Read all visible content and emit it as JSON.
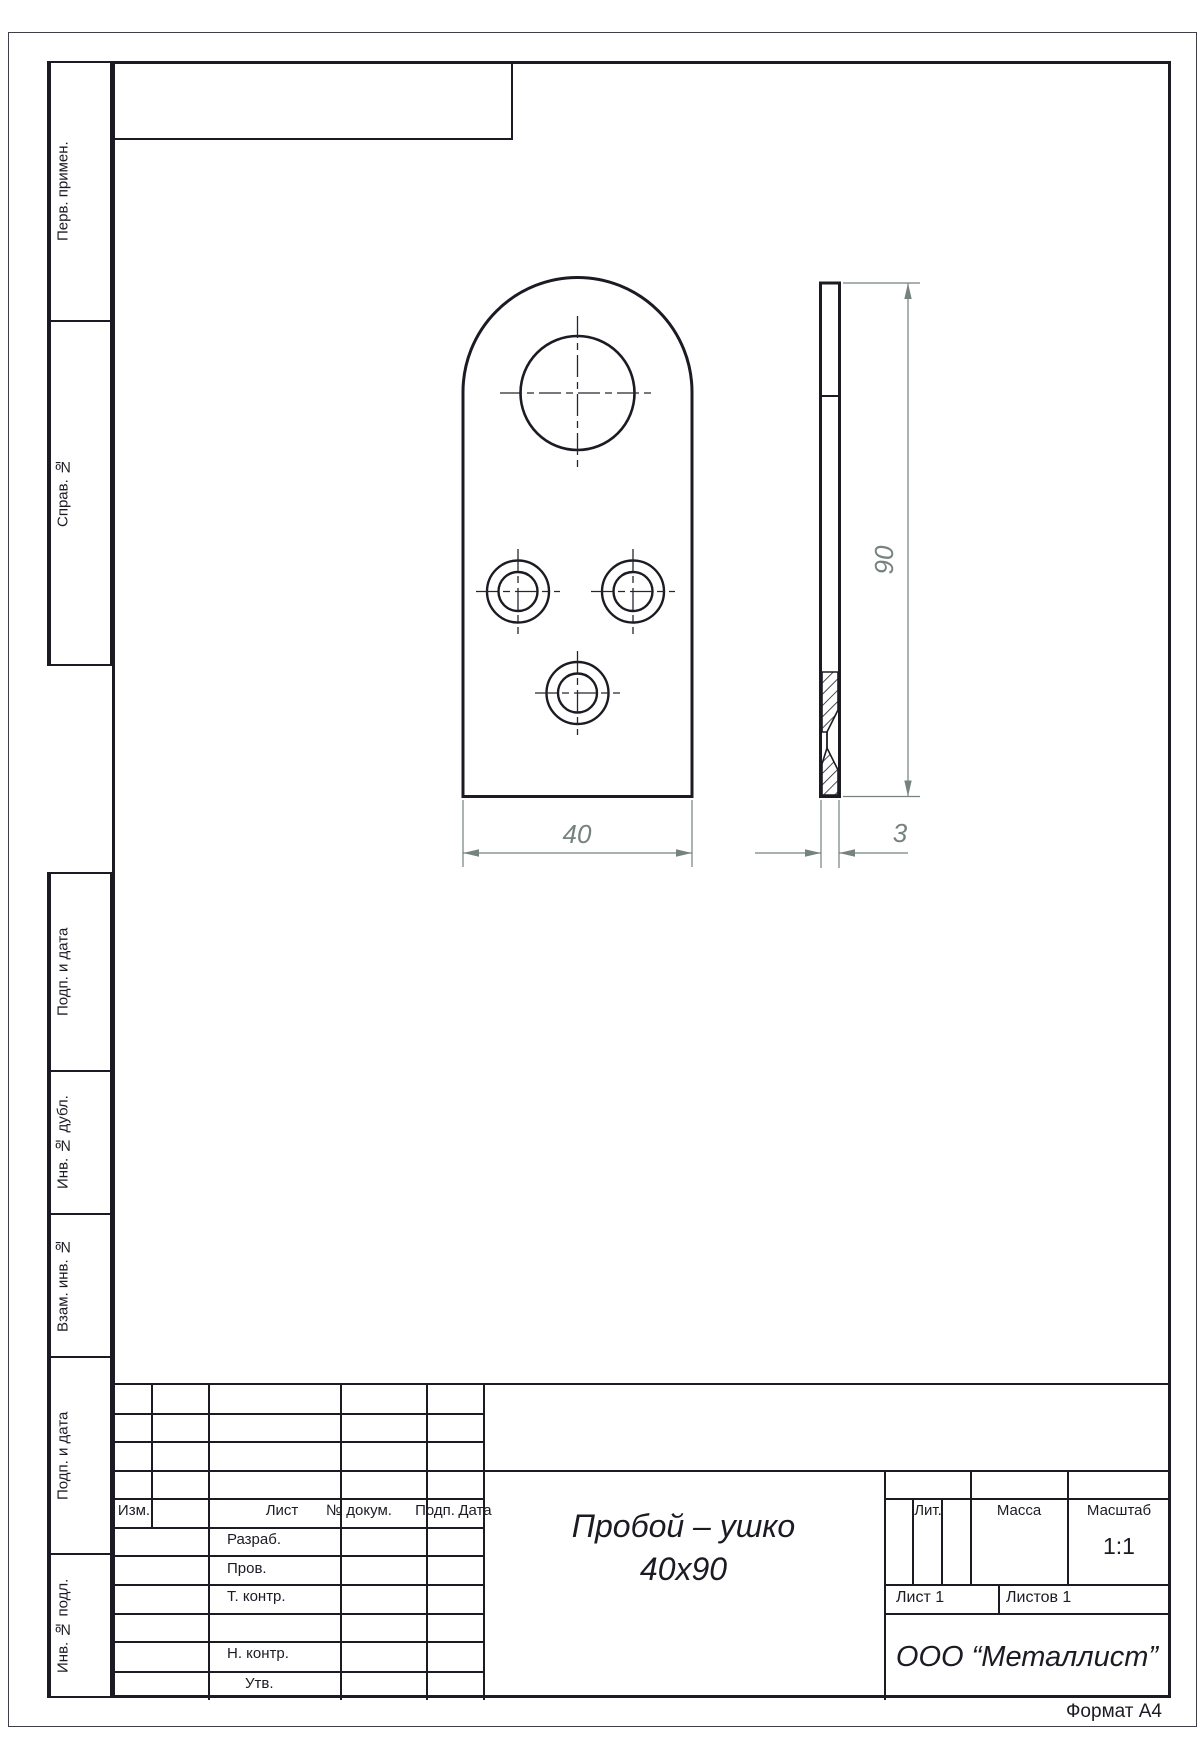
{
  "sheet": {
    "format": "Формат А4"
  },
  "sidebar": {
    "sections": [
      {
        "label": "Перв. примен."
      },
      {
        "label": "Справ. №"
      },
      {
        "label": "Подп. и дата"
      },
      {
        "label": "Инв. № дубл."
      },
      {
        "label": "Взам. инв. №"
      },
      {
        "label": "Подп. и дата"
      },
      {
        "label": "Инв. № подл."
      }
    ]
  },
  "title_block": {
    "header_cols": {
      "izm": "Изм.",
      "list": "Лист",
      "doc": "№ докум.",
      "podp": "Подп.",
      "data": "Дата"
    },
    "rows": {
      "razrab": "Разраб.",
      "prov": "Пров.",
      "tkontr": "Т. контр.",
      "nkontr": "Н. контр.",
      "utv": "Утв."
    },
    "lit": "Лит.",
    "massa": "Масса",
    "masshtab": "Масштаб",
    "scale": "1:1",
    "sheet_no": "Лист 1",
    "sheets_total": "Листов 1",
    "company": "ООО “Металлист”",
    "part_name_line1": "Пробой – ушко",
    "part_name_line2": "40х90"
  },
  "dimensions": {
    "width": "40",
    "height": "90",
    "thickness": "3"
  },
  "colors": {
    "line": "#1b1b24",
    "dim": "#75827f"
  }
}
